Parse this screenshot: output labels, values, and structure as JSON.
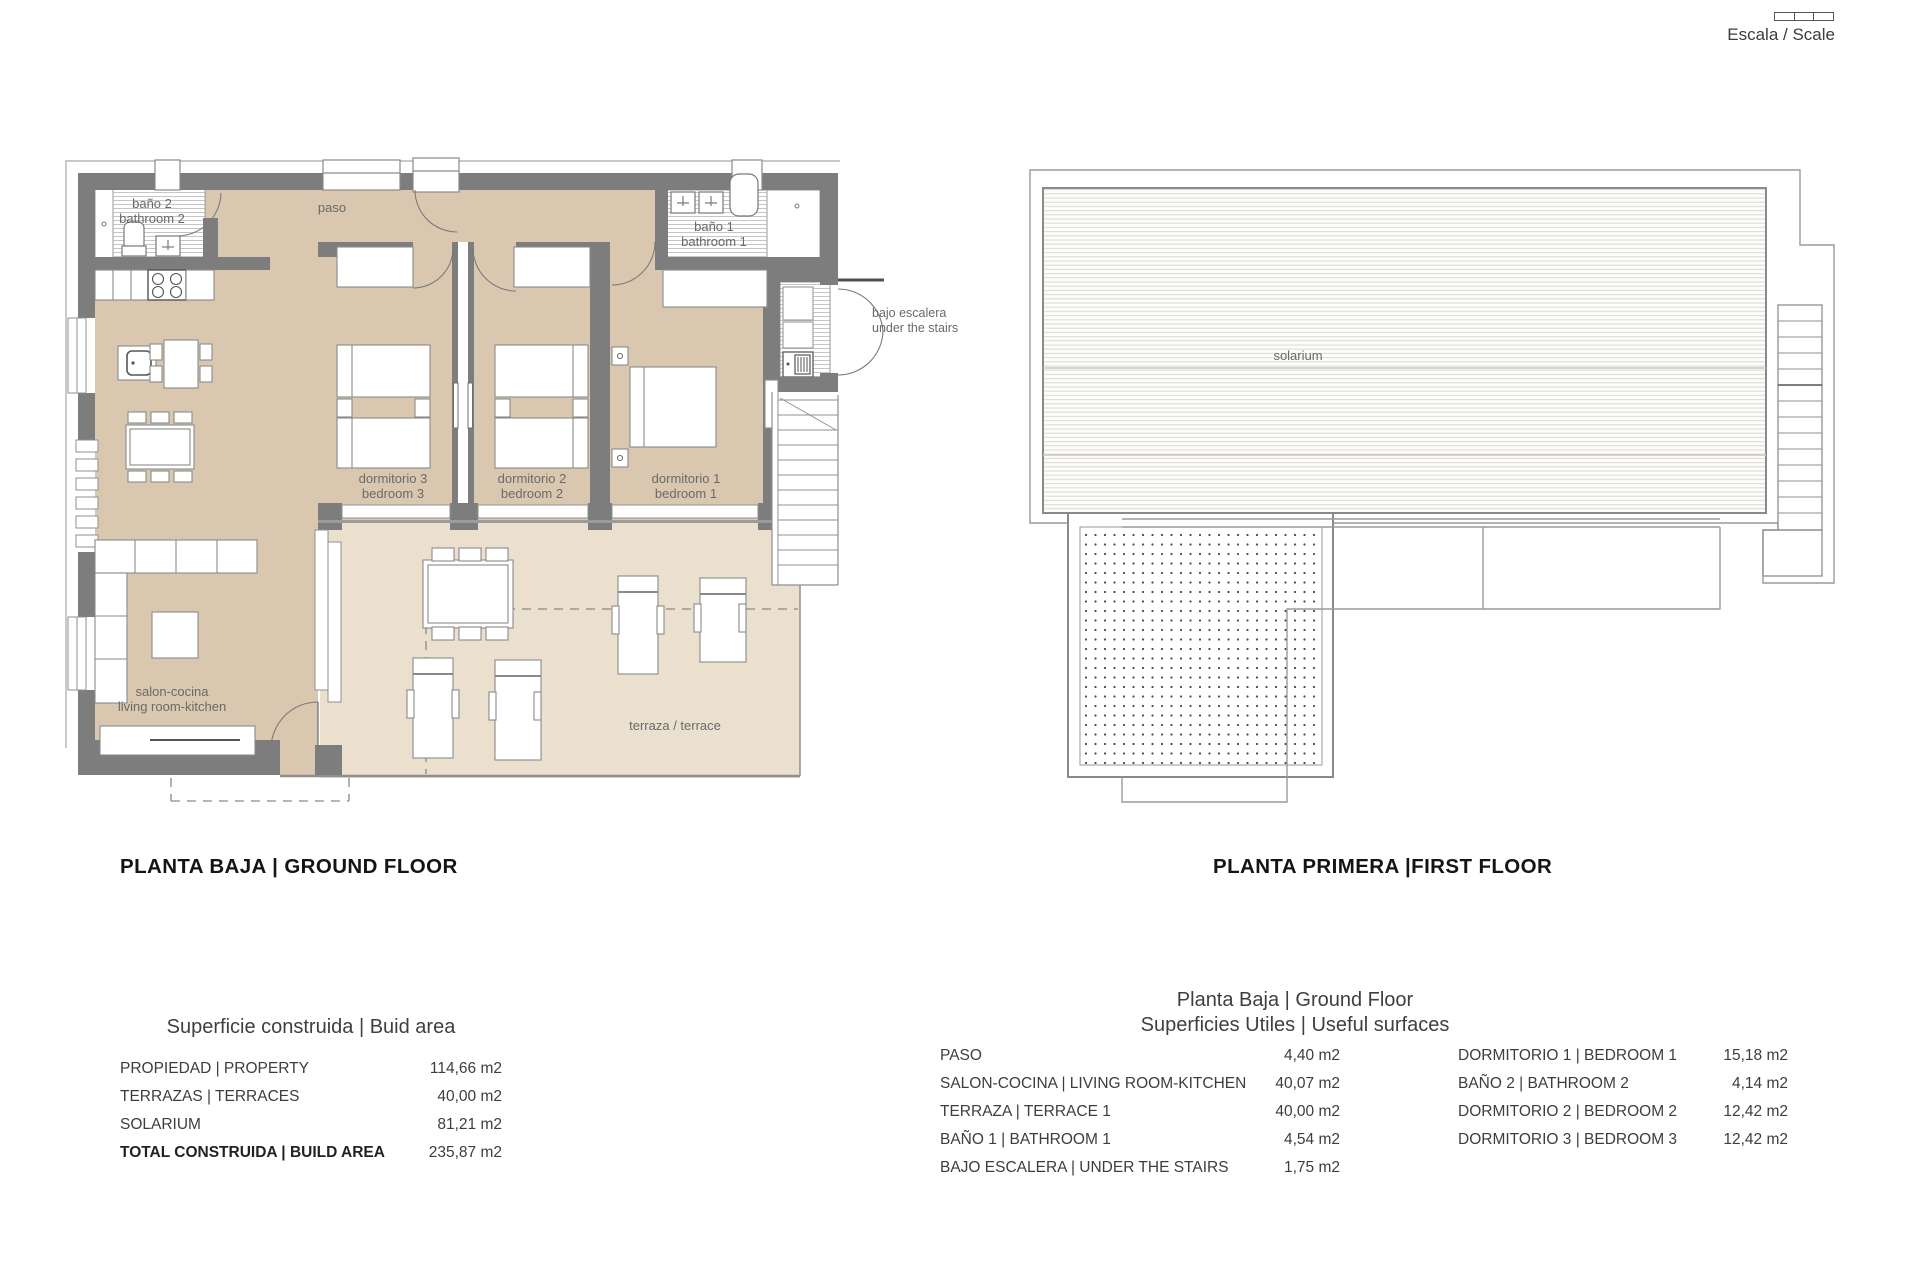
{
  "scale": {
    "label": "Escala / Scale"
  },
  "plans": {
    "ground": {
      "title": "PLANTA BAJA | GROUND FLOOR",
      "rooms": {
        "bano2_l1": "baño 2",
        "bano2_l2": "bathroom 2",
        "paso": "paso",
        "bano1_l1": "baño 1",
        "bano1_l2": "bathroom 1",
        "bajo_escalera_l1": "bajo escalera",
        "bajo_escalera_l2": "under the stairs",
        "dorm3_l1": "dormitorio 3",
        "dorm3_l2": "bedroom 3",
        "dorm2_l1": "dormitorio 2",
        "dorm2_l2": "bedroom 2",
        "dorm1_l1": "dormitorio 1",
        "dorm1_l2": "bedroom 1",
        "salon_l1": "salon-cocina",
        "salon_l2": "living room-kitchen",
        "terraza": "terraza / terrace"
      }
    },
    "first": {
      "title": "PLANTA PRIMERA |FIRST FLOOR",
      "rooms": {
        "solarium": "solarium"
      }
    }
  },
  "build_area_table": {
    "title": "Superficie construida | Buid area",
    "rows": [
      {
        "label": "PROPIEDAD | PROPERTY",
        "value": "114,66 m2"
      },
      {
        "label": "TERRAZAS | TERRACES",
        "value": "40,00 m2"
      },
      {
        "label": "SOLARIUM",
        "value": "81,21 m2"
      },
      {
        "label": "TOTAL CONSTRUIDA | BUILD AREA",
        "value": "235,87 m2"
      }
    ]
  },
  "useful_surfaces_table": {
    "heading1": "Planta Baja | Ground Floor",
    "heading2": "Superficies Utiles | Useful surfaces",
    "left_rows": [
      {
        "label": "PASO",
        "value": "4,40 m2"
      },
      {
        "label": "SALON-COCINA | LIVING ROOM-KITCHEN",
        "value": "40,07 m2"
      },
      {
        "label": "TERRAZA | TERRACE 1",
        "value": "40,00 m2"
      },
      {
        "label": "BAÑO 1 | BATHROOM 1",
        "value": "4,54 m2"
      },
      {
        "label": "BAJO ESCALERA | UNDER THE STAIRS",
        "value": "1,75 m2"
      }
    ],
    "right_rows": [
      {
        "label": "DORMITORIO 1 | BEDROOM 1",
        "value": "15,18 m2"
      },
      {
        "label": "BAÑO 2 | BATHROOM 2",
        "value": "4,14 m2"
      },
      {
        "label": "DORMITORIO 2 | BEDROOM 2",
        "value": "12,42 m2"
      },
      {
        "label": "DORMITORIO 3 | BEDROOM 3",
        "value": "12,42 m2"
      }
    ]
  },
  "colors": {
    "wall": "#7d7d7d",
    "floor": "#d9c8af",
    "terrace": "#eae0cd",
    "line": "#9b9b9b",
    "label": "#6a6a6a"
  }
}
